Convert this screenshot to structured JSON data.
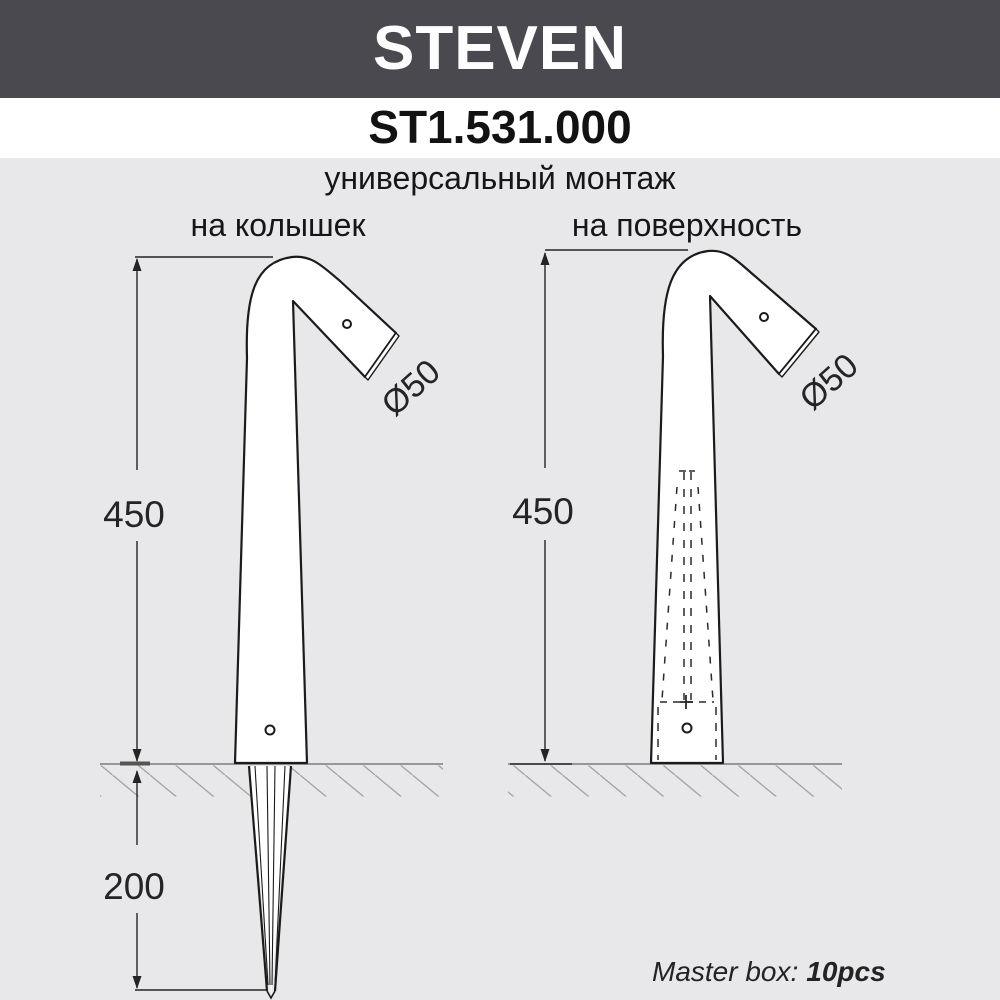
{
  "header": {
    "brand": "STEVEN",
    "model": "ST1.531.000",
    "subtitle": "универсальный монтаж"
  },
  "columns": {
    "left_label": "на колышек",
    "right_label": "на поверхность"
  },
  "drawings": {
    "left": {
      "mount_type": "на колышек",
      "height_dim": "450",
      "spike_depth_dim": "200",
      "diameter_dim": "Ø50"
    },
    "right": {
      "mount_type": "на поверхность",
      "height_dim": "450",
      "diameter_dim": "Ø50"
    }
  },
  "footer": {
    "master_box_label": "Master box:",
    "master_box_qty": "10pcs"
  },
  "colors": {
    "banner_bg": "#4b4950",
    "banner_text": "#fdfdfd",
    "page_bg": "#e8e7e9",
    "strip_bg": "#ffffff",
    "outline": "#1b1b1b",
    "ground": "#7d7d7d",
    "hatch": "#a3a3a3"
  }
}
